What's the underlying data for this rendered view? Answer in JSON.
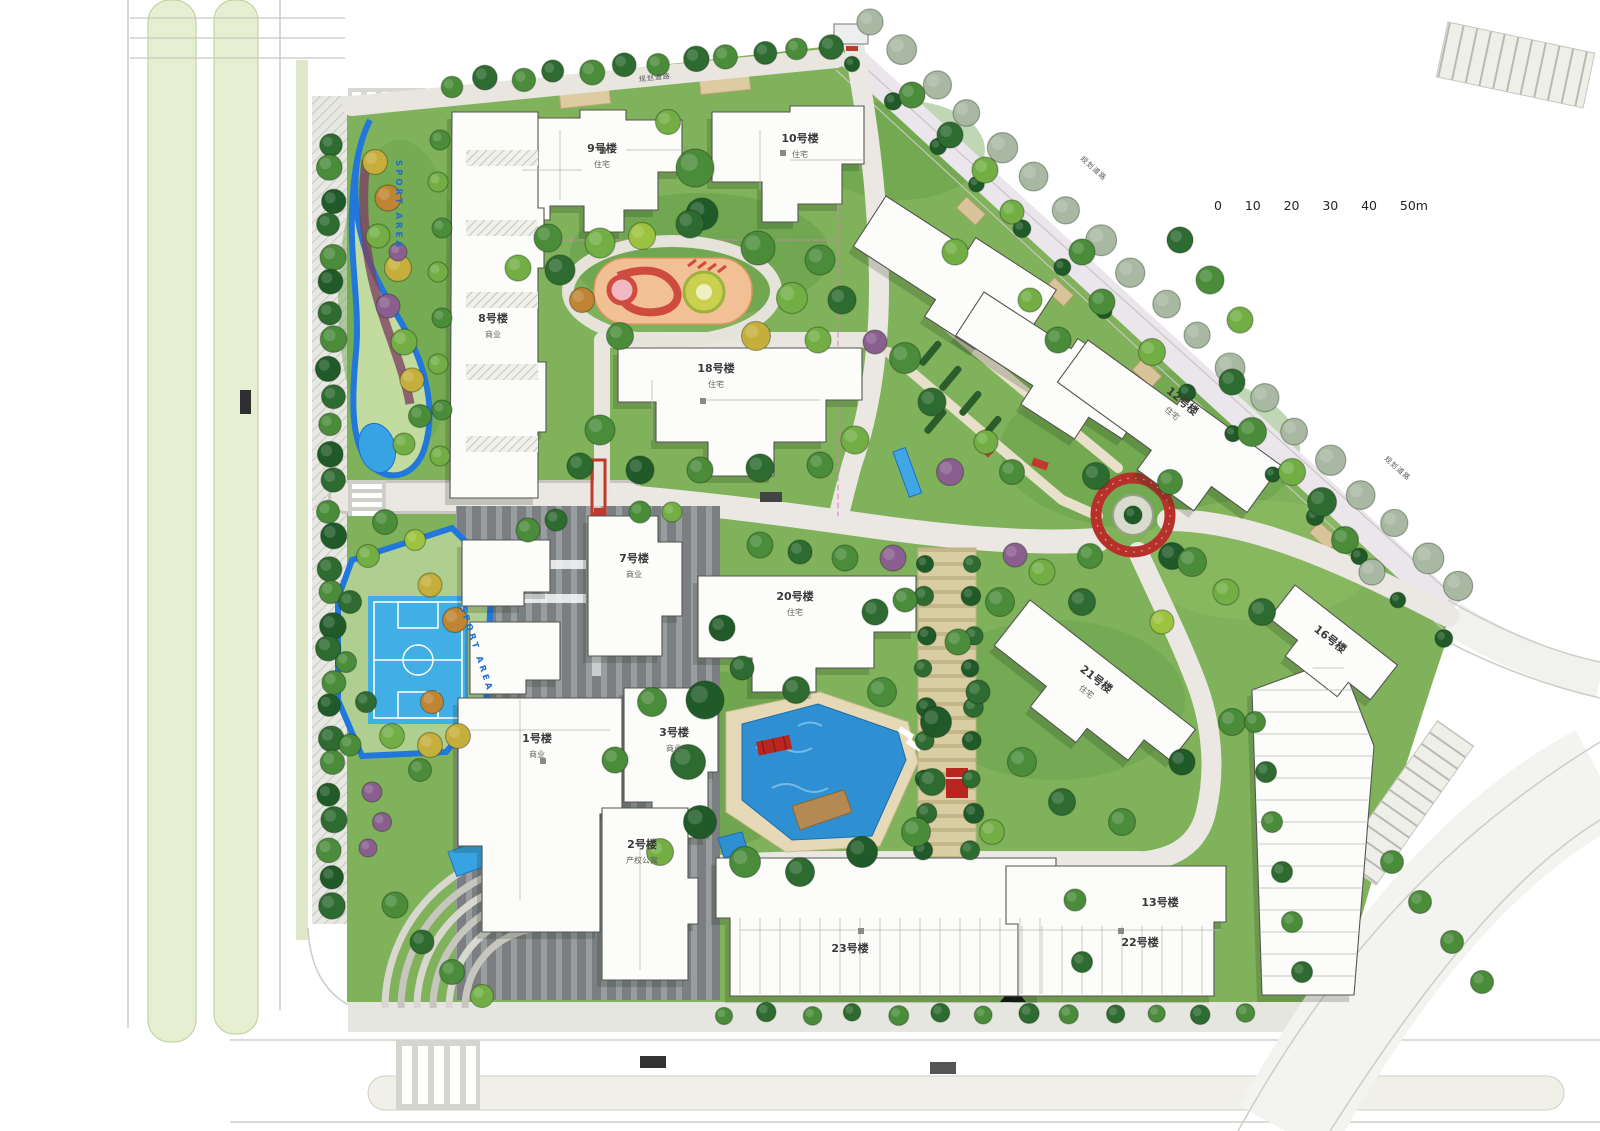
{
  "scale_bar": {
    "unit_labels": [
      "0",
      "10",
      "20",
      "30",
      "40",
      "50m"
    ]
  },
  "buildings": [
    {
      "id": "b9",
      "label": "9号楼",
      "sublabel": "住宅",
      "x": 602,
      "y": 152,
      "rot": 0
    },
    {
      "id": "b10",
      "label": "10号楼",
      "sublabel": "住宅",
      "x": 800,
      "y": 142,
      "rot": 0
    },
    {
      "id": "b8",
      "label": "8号楼",
      "sublabel": "商业",
      "x": 493,
      "y": 322,
      "rot": 0
    },
    {
      "id": "b18",
      "label": "18号楼",
      "sublabel": "住宅",
      "x": 716,
      "y": 372,
      "rot": 0
    },
    {
      "id": "b12",
      "label": "12号楼",
      "sublabel": "住宅",
      "x": 1180,
      "y": 404,
      "rot": 40
    },
    {
      "id": "b7",
      "label": "7号楼",
      "sublabel": "商业",
      "x": 634,
      "y": 562,
      "rot": 0
    },
    {
      "id": "b20",
      "label": "20号楼",
      "sublabel": "住宅",
      "x": 795,
      "y": 600,
      "rot": 0
    },
    {
      "id": "b21",
      "label": "21号楼",
      "sublabel": "住宅",
      "x": 1094,
      "y": 682,
      "rot": 38
    },
    {
      "id": "b16",
      "label": "16号楼",
      "sublabel": "",
      "x": 1328,
      "y": 642,
      "rot": 38
    },
    {
      "id": "b1",
      "label": "1号楼",
      "sublabel": "商业",
      "x": 537,
      "y": 742,
      "rot": 0
    },
    {
      "id": "b3",
      "label": "3号楼",
      "sublabel": "商业",
      "x": 674,
      "y": 736,
      "rot": 0
    },
    {
      "id": "b2",
      "label": "2号楼",
      "sublabel": "产权公寓",
      "x": 642,
      "y": 848,
      "rot": 0
    },
    {
      "id": "b23",
      "label": "23号楼",
      "sublabel": "",
      "x": 850,
      "y": 952,
      "rot": 0
    },
    {
      "id": "b13",
      "label": "13号楼",
      "sublabel": "",
      "x": 1160,
      "y": 906,
      "rot": 0
    },
    {
      "id": "b22",
      "label": "22号楼",
      "sublabel": "",
      "x": 1140,
      "y": 946,
      "rot": 0
    }
  ],
  "annotations": [
    {
      "id": "sport-area-track",
      "text": "SPORT AREA",
      "x": 396,
      "y": 205,
      "rot": 90,
      "style": "blue"
    },
    {
      "id": "sport-area-court",
      "text": "SPORT AREA",
      "x": 474,
      "y": 650,
      "rot": 72,
      "style": "blue"
    },
    {
      "id": "road-label-north",
      "text": "规划道路",
      "x": 655,
      "y": 80,
      "rot": -6,
      "style": "road"
    },
    {
      "id": "road-label-ne-1",
      "text": "规划道路",
      "x": 1092,
      "y": 170,
      "rot": 42,
      "style": "road"
    },
    {
      "id": "road-label-ne-2",
      "text": "规划道路",
      "x": 1396,
      "y": 470,
      "rot": 42,
      "style": "road"
    }
  ],
  "colors": {
    "grass": "#7fb25a",
    "water": "#2e8fd2",
    "track_blue": "#2277dd",
    "building": "#fcfcfa",
    "red_feature": "#b8302a",
    "plaza": "#7c8083",
    "playground_base": "#f1c195",
    "deck_tan": "#e6d9b8"
  }
}
